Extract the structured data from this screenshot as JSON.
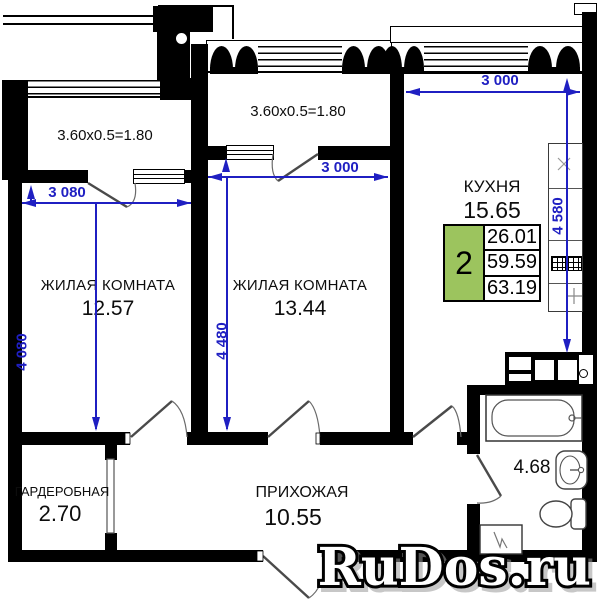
{
  "plan": {
    "windows": {
      "balcony1_formula": "3.60x0.5=1.80",
      "balcony2_formula": "3.60x0.5=1.80"
    },
    "rooms": {
      "living1": {
        "name": "ЖИЛАЯ КОМНАТА",
        "area": "12.57"
      },
      "living2": {
        "name": "ЖИЛАЯ КОМНАТА",
        "area": "13.44"
      },
      "kitchen": {
        "name": "КУХНЯ",
        "area": "15.65"
      },
      "hallway": {
        "name": "ПРИХОЖАЯ",
        "area": "10.55"
      },
      "wardrobe": {
        "name": "ГАРДЕРОБНАЯ",
        "area": "2.70"
      },
      "bathroom": {
        "area": "4.68"
      }
    },
    "dimensions": {
      "living1_width": "3 080",
      "living1_depth": "4 080",
      "living2_width": "3 000",
      "living2_depth": "4 480",
      "kitchen_width": "3 000",
      "kitchen_depth": "4 580"
    },
    "spec_table": {
      "rooms": "2",
      "living_area": "26.01",
      "apartment_area": "59.59",
      "total_area": "63.19"
    },
    "watermark": "RuDos.ru",
    "colors": {
      "dimension": "#1f1fc2",
      "table_green": "#9cc45e",
      "wall": "#000000"
    }
  }
}
